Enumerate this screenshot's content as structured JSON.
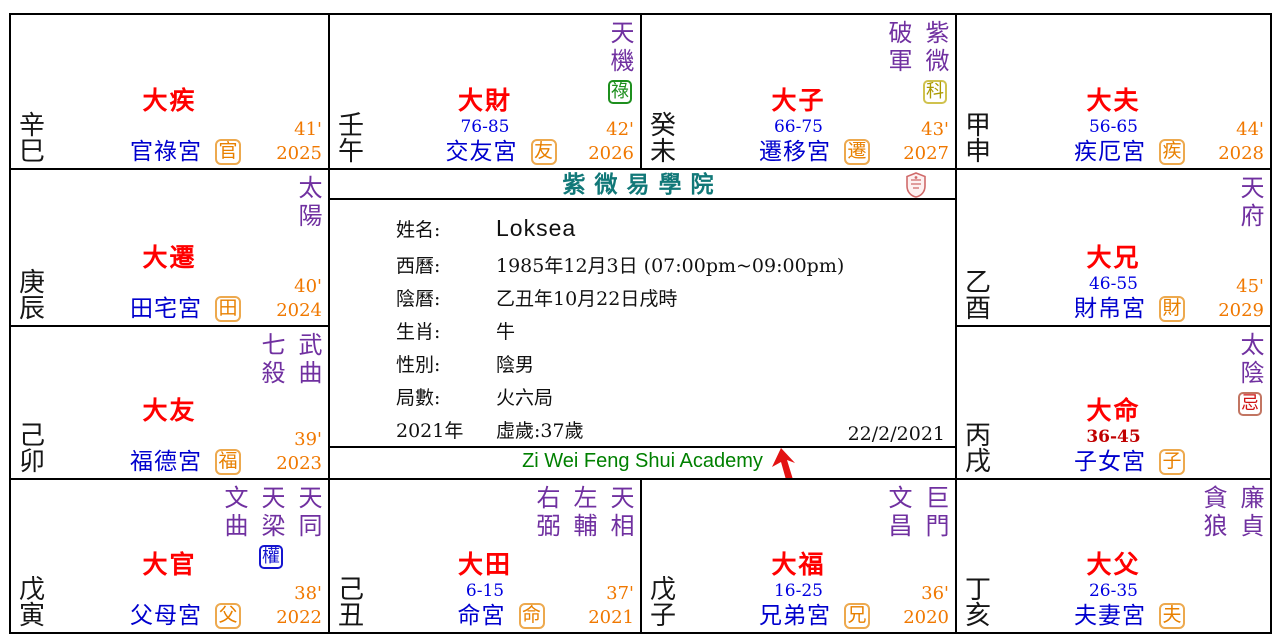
{
  "header": {
    "academy_cn": "紫微易學院",
    "academy_en": "Zi Wei Feng Shui Academy",
    "chart_date": "22/2/2021"
  },
  "profile": {
    "rows": [
      {
        "label": "姓名:",
        "value": "Loksea",
        "emphasis": true
      },
      {
        "label": "西曆:",
        "value": "1985年12月3日 (07:00pm~09:00pm)"
      },
      {
        "label": "陰曆:",
        "value": "乙丑年10月22日戌時"
      },
      {
        "label": "生肖:",
        "value": "牛"
      },
      {
        "label": "性別:",
        "value": "陰男"
      },
      {
        "label": "局數:",
        "value": "火六局"
      },
      {
        "label": "2021年",
        "value": "虛歲:37歲"
      }
    ]
  },
  "colors": {
    "star_purple": "#7030a0",
    "palace_blue": "#0000cd",
    "decade_red": "#ff0000",
    "current_range_red": "#c00000",
    "flow_orange": "#f07800",
    "title_teal": "#117878",
    "footer_green": "#008000",
    "hua_lu_green": "#1e8f1e",
    "hua_quan_blue": "#1515cf",
    "hua_ke_yellow": "#ab9a00",
    "hua_ji_red": "#cf1414",
    "arrow_green": "#12a12c",
    "cursor_red": "#e31212"
  },
  "palaces": [
    {
      "pos": "si",
      "stem_branch": "辛巳",
      "stars": [],
      "arrow": false,
      "da_label": "大疾",
      "age_range": "",
      "range_current": false,
      "palace_name": "官祿宮",
      "tag": "官",
      "minute": "41'",
      "year": "2025"
    },
    {
      "pos": "wu",
      "stem_branch": "壬午",
      "stars": [
        {
          "name": "天機",
          "hua": "祿",
          "hua_color": "green"
        }
      ],
      "arrow": false,
      "da_label": "大財",
      "age_range": "76-85",
      "range_current": false,
      "palace_name": "交友宮",
      "tag": "友",
      "minute": "42'",
      "year": "2026"
    },
    {
      "pos": "wei",
      "stem_branch": "癸未",
      "stars": [
        {
          "name": "破軍"
        },
        {
          "name": "紫微",
          "hua": "科",
          "hua_color": "yellow"
        }
      ],
      "arrow": true,
      "da_label": "大子",
      "age_range": "66-75",
      "range_current": false,
      "palace_name": "遷移宮",
      "tag": "遷",
      "minute": "43'",
      "year": "2027"
    },
    {
      "pos": "shen",
      "stem_branch": "甲申",
      "stars": [],
      "arrow": false,
      "da_label": "大夫",
      "age_range": "56-65",
      "range_current": false,
      "palace_name": "疾厄宮",
      "tag": "疾",
      "minute": "44'",
      "year": "2028"
    },
    {
      "pos": "chen",
      "stem_branch": "庚辰",
      "stars": [
        {
          "name": "太陽"
        }
      ],
      "arrow": true,
      "da_label": "大遷",
      "age_range": "",
      "range_current": false,
      "palace_name": "田宅宮",
      "tag": "田",
      "minute": "40'",
      "year": "2024"
    },
    {
      "pos": "you",
      "stem_branch": "乙酉",
      "stars": [
        {
          "name": "天府"
        }
      ],
      "arrow": false,
      "da_label": "大兄",
      "age_range": "46-55",
      "range_current": false,
      "palace_name": "財帛宮",
      "tag": "財",
      "minute": "45'",
      "year": "2029"
    },
    {
      "pos": "mao",
      "stem_branch": "己卯",
      "stars": [
        {
          "name": "七殺"
        },
        {
          "name": "武曲"
        }
      ],
      "arrow": true,
      "da_label": "大友",
      "age_range": "",
      "range_current": false,
      "palace_name": "福德宮",
      "tag": "福",
      "minute": "39'",
      "year": "2023"
    },
    {
      "pos": "xu",
      "stem_branch": "丙戌",
      "stars": [
        {
          "name": "太陰",
          "hua": "忌",
          "hua_color": "red"
        }
      ],
      "arrow": false,
      "da_label": "大命",
      "age_range": "36-45",
      "range_current": true,
      "palace_name": "子女宮",
      "tag": "子",
      "minute": "",
      "year": ""
    },
    {
      "pos": "yin",
      "stem_branch": "戊寅",
      "stars": [
        {
          "name": "文曲"
        },
        {
          "name": "天梁",
          "hua": "權",
          "hua_color": "blue"
        },
        {
          "name": "天同"
        }
      ],
      "arrow": false,
      "da_label": "大官",
      "age_range": "",
      "range_current": false,
      "palace_name": "父母宮",
      "tag": "父",
      "minute": "38'",
      "year": "2022"
    },
    {
      "pos": "chou",
      "stem_branch": "己丑",
      "stars": [
        {
          "name": "右弼"
        },
        {
          "name": "左輔"
        },
        {
          "name": "天相"
        }
      ],
      "arrow": false,
      "da_label": "大田",
      "age_range": "6-15",
      "range_current": false,
      "palace_name": "命宮",
      "tag": "命",
      "minute": "37'",
      "year": "2021"
    },
    {
      "pos": "zi",
      "stem_branch": "戊子",
      "stars": [
        {
          "name": "文昌"
        },
        {
          "name": "巨門"
        }
      ],
      "arrow": false,
      "da_label": "大福",
      "age_range": "16-25",
      "range_current": false,
      "palace_name": "兄弟宮",
      "tag": "兄",
      "minute": "36'",
      "year": "2020"
    },
    {
      "pos": "hai",
      "stem_branch": "丁亥",
      "stars": [
        {
          "name": "貪狼"
        },
        {
          "name": "廉貞"
        }
      ],
      "arrow": false,
      "da_label": "大父",
      "age_range": "26-35",
      "range_current": false,
      "palace_name": "夫妻宮",
      "tag": "夫",
      "minute": "",
      "year": ""
    }
  ]
}
